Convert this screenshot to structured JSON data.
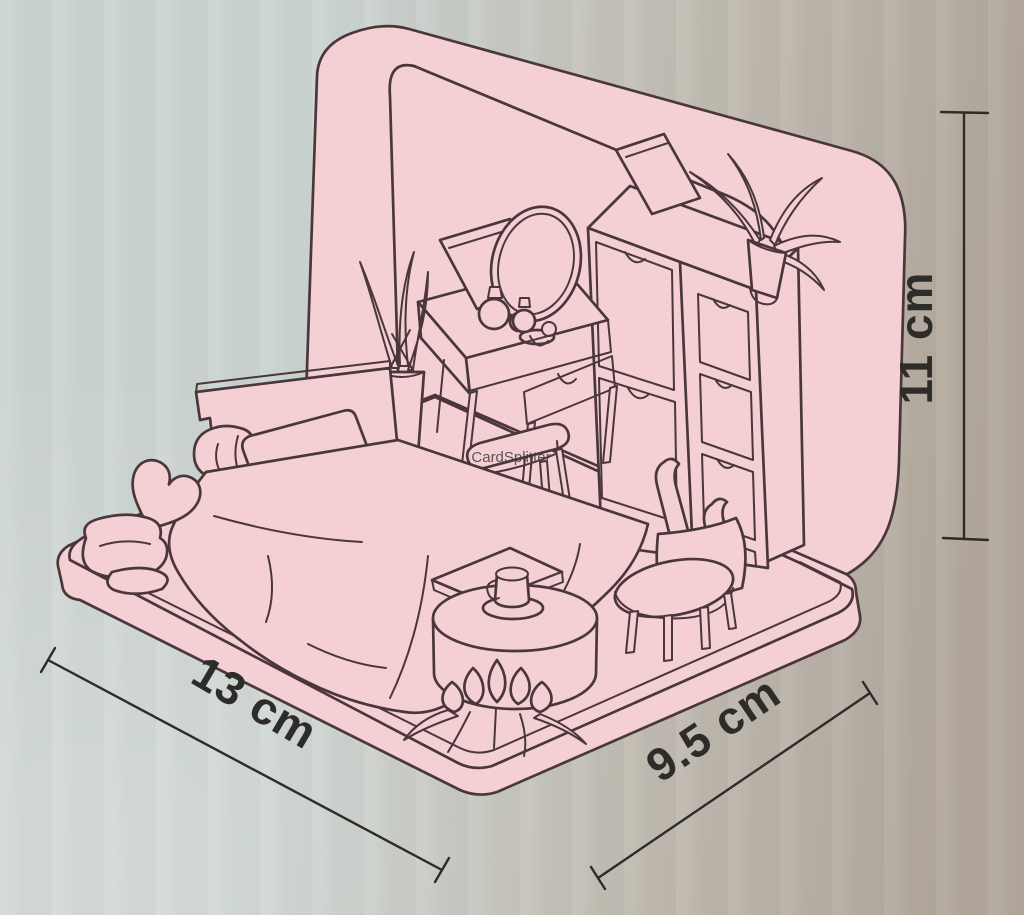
{
  "diagram": {
    "subject": "miniature tin-box bedroom roombox dimensions diagram",
    "watermark": "CardSplitter",
    "dimensions": {
      "width_label": "13 cm",
      "depth_label": "9.5 cm",
      "height_label": "11 cm"
    }
  },
  "colors": {
    "background_left": "#ccd4d2",
    "background_mid": "#c2bdb3",
    "background_right": "#b2a89d",
    "box_fill": "#f4cfd4",
    "outline": "#4a373a",
    "dimension_ink": "#2e2c28",
    "watermark_ink": "#3f3e3c"
  }
}
